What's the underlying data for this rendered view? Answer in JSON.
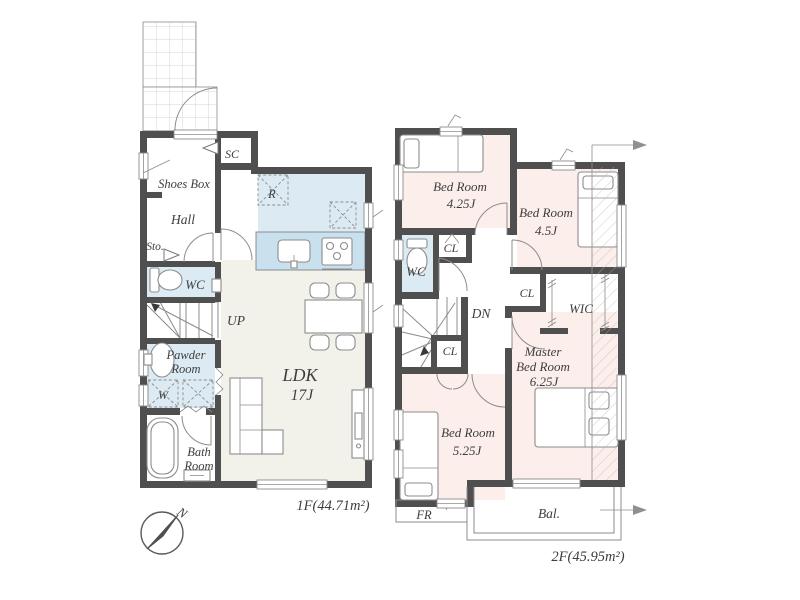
{
  "colors": {
    "wall": "#4f4f4f",
    "line": "#8c8c8c",
    "ink": "#3e3e3e",
    "bedroom": "#fbeeeb",
    "wet": "#dcebf3",
    "kitchen": "#dcebf3",
    "counter": "#c9e0ee",
    "ldk": "#f3f2ea",
    "hatch": "#c0b3ad"
  },
  "floor1": {
    "area_label": "1F(44.71m²)",
    "rooms": {
      "sc": "SC",
      "shoes_box": "Shoes Box",
      "hall": "Hall",
      "sto": "Sto.",
      "wc": "WC",
      "up": "UP",
      "powder_l1": "Pawder",
      "powder_l2": "Room",
      "washer": "W",
      "fridge": "R",
      "bath_l1": "Bath",
      "bath_l2": "Room",
      "ldk_l1": "LDK",
      "ldk_l2": "17J"
    }
  },
  "floor2": {
    "area_label": "2F(45.95m²)",
    "rooms": {
      "bed1_l1": "Bed Room",
      "bed1_l2": "4.25J",
      "bed2_l1": "Bed Room",
      "bed2_l2": "4.5J",
      "wc": "WC",
      "cl_a": "CL",
      "cl_b": "CL",
      "cl_c": "CL",
      "dn": "DN",
      "wic": "WIC",
      "master_l1": "Master",
      "master_l2": "Bed Room",
      "master_l3": "6.25J",
      "bed3_l1": "Bed Room",
      "bed3_l2": "5.25J",
      "fr": "FR",
      "balcony": "Bal."
    }
  },
  "compass": {
    "north": "N"
  }
}
